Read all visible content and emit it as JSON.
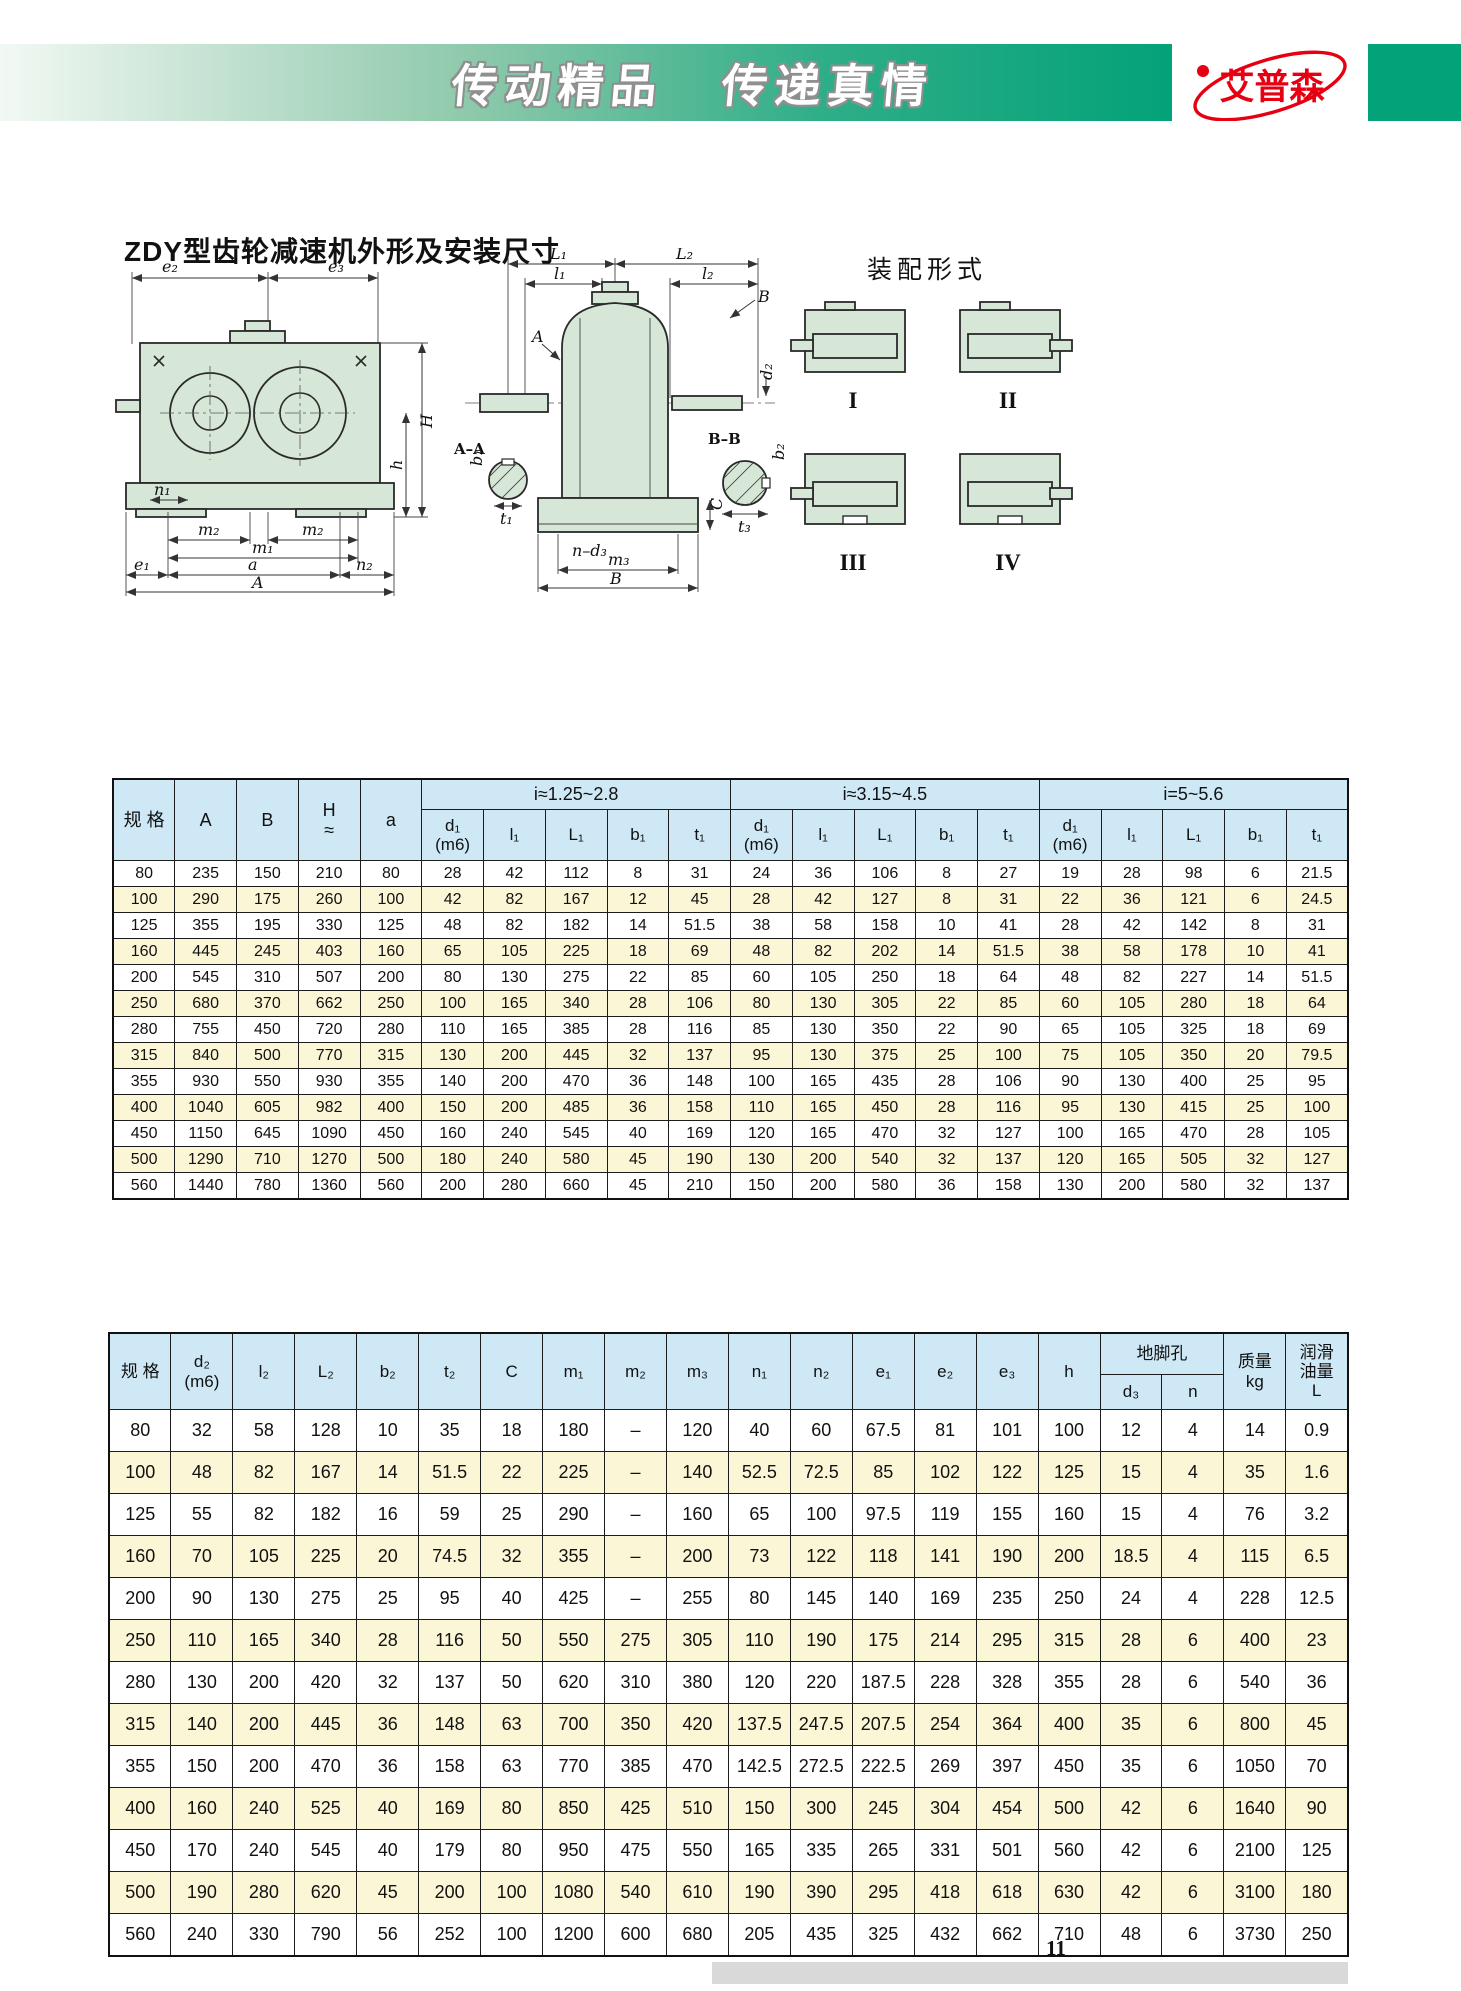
{
  "colors": {
    "band_green": "#04a278",
    "logo_red": "#e60012",
    "table_header_blue": "#cfe8f5",
    "row_yellow": "#fbf6d5",
    "drawing_green": "#d7e7d7"
  },
  "header": {
    "slogan_part1": "传动精品",
    "slogan_part2": "传递真情",
    "logo_text": "艾普森"
  },
  "title": "ZDY型齿轮减速机外形及安装尺寸",
  "drawings": {
    "assembly_title": "装配形式",
    "assembly_labels": [
      "I",
      "II",
      "III",
      "IV"
    ],
    "front_labels": {
      "e2": "e₂",
      "e3": "e₃",
      "H": "H",
      "h": "h",
      "n1": "n₁",
      "m2": "m₂",
      "m1": "m₁",
      "e1": "e₁",
      "a": "a",
      "n2": "n₂",
      "A": "A"
    },
    "side_labels": {
      "L1": "L₁",
      "L2": "L₂",
      "l1": "l₁",
      "l2": "l₂",
      "A": "A",
      "B": "B",
      "d2": "d₂",
      "AA": "A–A",
      "b1": "b₁",
      "t1": "t₁",
      "BB": "B–B",
      "b2": "b₂",
      "t3": "t₃",
      "C": "C",
      "nd3": "n–d₃",
      "m3": "m₃",
      "Bb": "B"
    }
  },
  "table1": {
    "header": {
      "spec": "规 格",
      "A": "A",
      "B": "B",
      "H": "H\n≈",
      "a": "a",
      "groups": [
        "i≈1.25~2.8",
        "i≈3.15~4.5",
        "i=5~5.6"
      ],
      "subs": [
        "d₁\n(m6)",
        "l₁",
        "L₁",
        "b₁",
        "t₁"
      ]
    },
    "rows": [
      [
        "80",
        "235",
        "150",
        "210",
        "80",
        "28",
        "42",
        "112",
        "8",
        "31",
        "24",
        "36",
        "106",
        "8",
        "27",
        "19",
        "28",
        "98",
        "6",
        "21.5"
      ],
      [
        "100",
        "290",
        "175",
        "260",
        "100",
        "42",
        "82",
        "167",
        "12",
        "45",
        "28",
        "42",
        "127",
        "8",
        "31",
        "22",
        "36",
        "121",
        "6",
        "24.5"
      ],
      [
        "125",
        "355",
        "195",
        "330",
        "125",
        "48",
        "82",
        "182",
        "14",
        "51.5",
        "38",
        "58",
        "158",
        "10",
        "41",
        "28",
        "42",
        "142",
        "8",
        "31"
      ],
      [
        "160",
        "445",
        "245",
        "403",
        "160",
        "65",
        "105",
        "225",
        "18",
        "69",
        "48",
        "82",
        "202",
        "14",
        "51.5",
        "38",
        "58",
        "178",
        "10",
        "41"
      ],
      [
        "200",
        "545",
        "310",
        "507",
        "200",
        "80",
        "130",
        "275",
        "22",
        "85",
        "60",
        "105",
        "250",
        "18",
        "64",
        "48",
        "82",
        "227",
        "14",
        "51.5"
      ],
      [
        "250",
        "680",
        "370",
        "662",
        "250",
        "100",
        "165",
        "340",
        "28",
        "106",
        "80",
        "130",
        "305",
        "22",
        "85",
        "60",
        "105",
        "280",
        "18",
        "64"
      ],
      [
        "280",
        "755",
        "450",
        "720",
        "280",
        "110",
        "165",
        "385",
        "28",
        "116",
        "85",
        "130",
        "350",
        "22",
        "90",
        "65",
        "105",
        "325",
        "18",
        "69"
      ],
      [
        "315",
        "840",
        "500",
        "770",
        "315",
        "130",
        "200",
        "445",
        "32",
        "137",
        "95",
        "130",
        "375",
        "25",
        "100",
        "75",
        "105",
        "350",
        "20",
        "79.5"
      ],
      [
        "355",
        "930",
        "550",
        "930",
        "355",
        "140",
        "200",
        "470",
        "36",
        "148",
        "100",
        "165",
        "435",
        "28",
        "106",
        "90",
        "130",
        "400",
        "25",
        "95"
      ],
      [
        "400",
        "1040",
        "605",
        "982",
        "400",
        "150",
        "200",
        "485",
        "36",
        "158",
        "110",
        "165",
        "450",
        "28",
        "116",
        "95",
        "130",
        "415",
        "25",
        "100"
      ],
      [
        "450",
        "1150",
        "645",
        "1090",
        "450",
        "160",
        "240",
        "545",
        "40",
        "169",
        "120",
        "165",
        "470",
        "32",
        "127",
        "100",
        "165",
        "470",
        "28",
        "105"
      ],
      [
        "500",
        "1290",
        "710",
        "1270",
        "500",
        "180",
        "240",
        "580",
        "45",
        "190",
        "130",
        "200",
        "540",
        "32",
        "137",
        "120",
        "165",
        "505",
        "32",
        "127"
      ],
      [
        "560",
        "1440",
        "780",
        "1360",
        "560",
        "200",
        "280",
        "660",
        "45",
        "210",
        "150",
        "200",
        "580",
        "36",
        "158",
        "130",
        "200",
        "580",
        "32",
        "137"
      ]
    ]
  },
  "table2": {
    "header": {
      "spec": "规 格",
      "d2": "d₂\n(m6)",
      "l2": "l₂",
      "L2": "L₂",
      "b2": "b₂",
      "t2": "t₂",
      "C": "C",
      "m1": "m₁",
      "m2": "m₂",
      "m3": "m₃",
      "n1": "n₁",
      "n2": "n₂",
      "e1": "e₁",
      "e2": "e₂",
      "e3": "e₃",
      "h": "h",
      "foot_hole": "地脚孔",
      "d3": "d₃",
      "n": "n",
      "mass": "质量\nkg",
      "oil": "润滑\n油量\nL"
    },
    "rows": [
      [
        "80",
        "32",
        "58",
        "128",
        "10",
        "35",
        "18",
        "180",
        "–",
        "120",
        "40",
        "60",
        "67.5",
        "81",
        "101",
        "100",
        "12",
        "4",
        "14",
        "0.9"
      ],
      [
        "100",
        "48",
        "82",
        "167",
        "14",
        "51.5",
        "22",
        "225",
        "–",
        "140",
        "52.5",
        "72.5",
        "85",
        "102",
        "122",
        "125",
        "15",
        "4",
        "35",
        "1.6"
      ],
      [
        "125",
        "55",
        "82",
        "182",
        "16",
        "59",
        "25",
        "290",
        "–",
        "160",
        "65",
        "100",
        "97.5",
        "119",
        "155",
        "160",
        "15",
        "4",
        "76",
        "3.2"
      ],
      [
        "160",
        "70",
        "105",
        "225",
        "20",
        "74.5",
        "32",
        "355",
        "–",
        "200",
        "73",
        "122",
        "118",
        "141",
        "190",
        "200",
        "18.5",
        "4",
        "115",
        "6.5"
      ],
      [
        "200",
        "90",
        "130",
        "275",
        "25",
        "95",
        "40",
        "425",
        "–",
        "255",
        "80",
        "145",
        "140",
        "169",
        "235",
        "250",
        "24",
        "4",
        "228",
        "12.5"
      ],
      [
        "250",
        "110",
        "165",
        "340",
        "28",
        "116",
        "50",
        "550",
        "275",
        "305",
        "110",
        "190",
        "175",
        "214",
        "295",
        "315",
        "28",
        "6",
        "400",
        "23"
      ],
      [
        "280",
        "130",
        "200",
        "420",
        "32",
        "137",
        "50",
        "620",
        "310",
        "380",
        "120",
        "220",
        "187.5",
        "228",
        "328",
        "355",
        "28",
        "6",
        "540",
        "36"
      ],
      [
        "315",
        "140",
        "200",
        "445",
        "36",
        "148",
        "63",
        "700",
        "350",
        "420",
        "137.5",
        "247.5",
        "207.5",
        "254",
        "364",
        "400",
        "35",
        "6",
        "800",
        "45"
      ],
      [
        "355",
        "150",
        "200",
        "470",
        "36",
        "158",
        "63",
        "770",
        "385",
        "470",
        "142.5",
        "272.5",
        "222.5",
        "269",
        "397",
        "450",
        "35",
        "6",
        "1050",
        "70"
      ],
      [
        "400",
        "160",
        "240",
        "525",
        "40",
        "169",
        "80",
        "850",
        "425",
        "510",
        "150",
        "300",
        "245",
        "304",
        "454",
        "500",
        "42",
        "6",
        "1640",
        "90"
      ],
      [
        "450",
        "170",
        "240",
        "545",
        "40",
        "179",
        "80",
        "950",
        "475",
        "550",
        "165",
        "335",
        "265",
        "331",
        "501",
        "560",
        "42",
        "6",
        "2100",
        "125"
      ],
      [
        "500",
        "190",
        "280",
        "620",
        "45",
        "200",
        "100",
        "1080",
        "540",
        "610",
        "190",
        "390",
        "295",
        "418",
        "618",
        "630",
        "42",
        "6",
        "3100",
        "180"
      ],
      [
        "560",
        "240",
        "330",
        "790",
        "56",
        "252",
        "100",
        "1200",
        "600",
        "680",
        "205",
        "435",
        "325",
        "432",
        "662",
        "710",
        "48",
        "6",
        "3730",
        "250"
      ]
    ]
  },
  "footer": {
    "page_number": "11"
  }
}
